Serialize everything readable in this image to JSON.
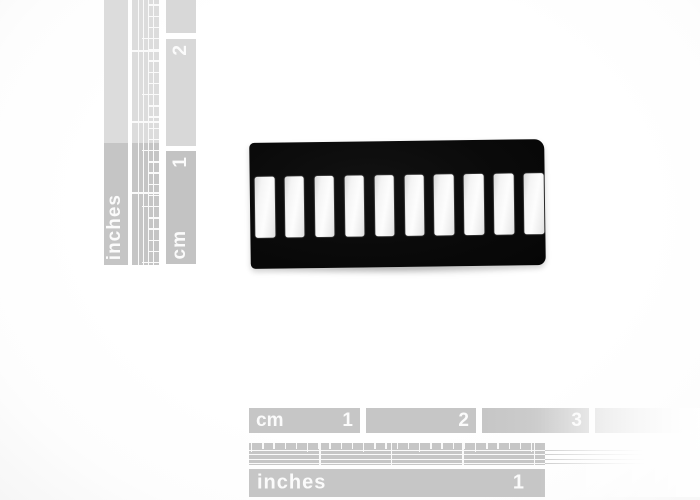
{
  "image_type": "product photograph",
  "background_color": "#ffffff",
  "product": {
    "name": "10-segment LED bar graph display",
    "body_color": "#0b0b0b",
    "segment_color": "#f5f5f5",
    "segment_count": 10
  },
  "left_ruler": {
    "orientation": "vertical",
    "inches_label": "inches",
    "cm_label": "cm",
    "cm_numbers": [
      "1",
      "2"
    ],
    "block_color_dark": "#c4c4c4",
    "block_color_light": "#d9d9d9",
    "ink_color": "#fbfbfb"
  },
  "bottom_ruler": {
    "orientation": "horizontal",
    "cm_label": "cm",
    "inches_label": "inches",
    "cm_numbers": [
      "1",
      "2",
      "3"
    ],
    "inch_numbers": [
      "1"
    ],
    "block_color": "#c6c6c6",
    "ink_color": "#fbfbfb"
  }
}
